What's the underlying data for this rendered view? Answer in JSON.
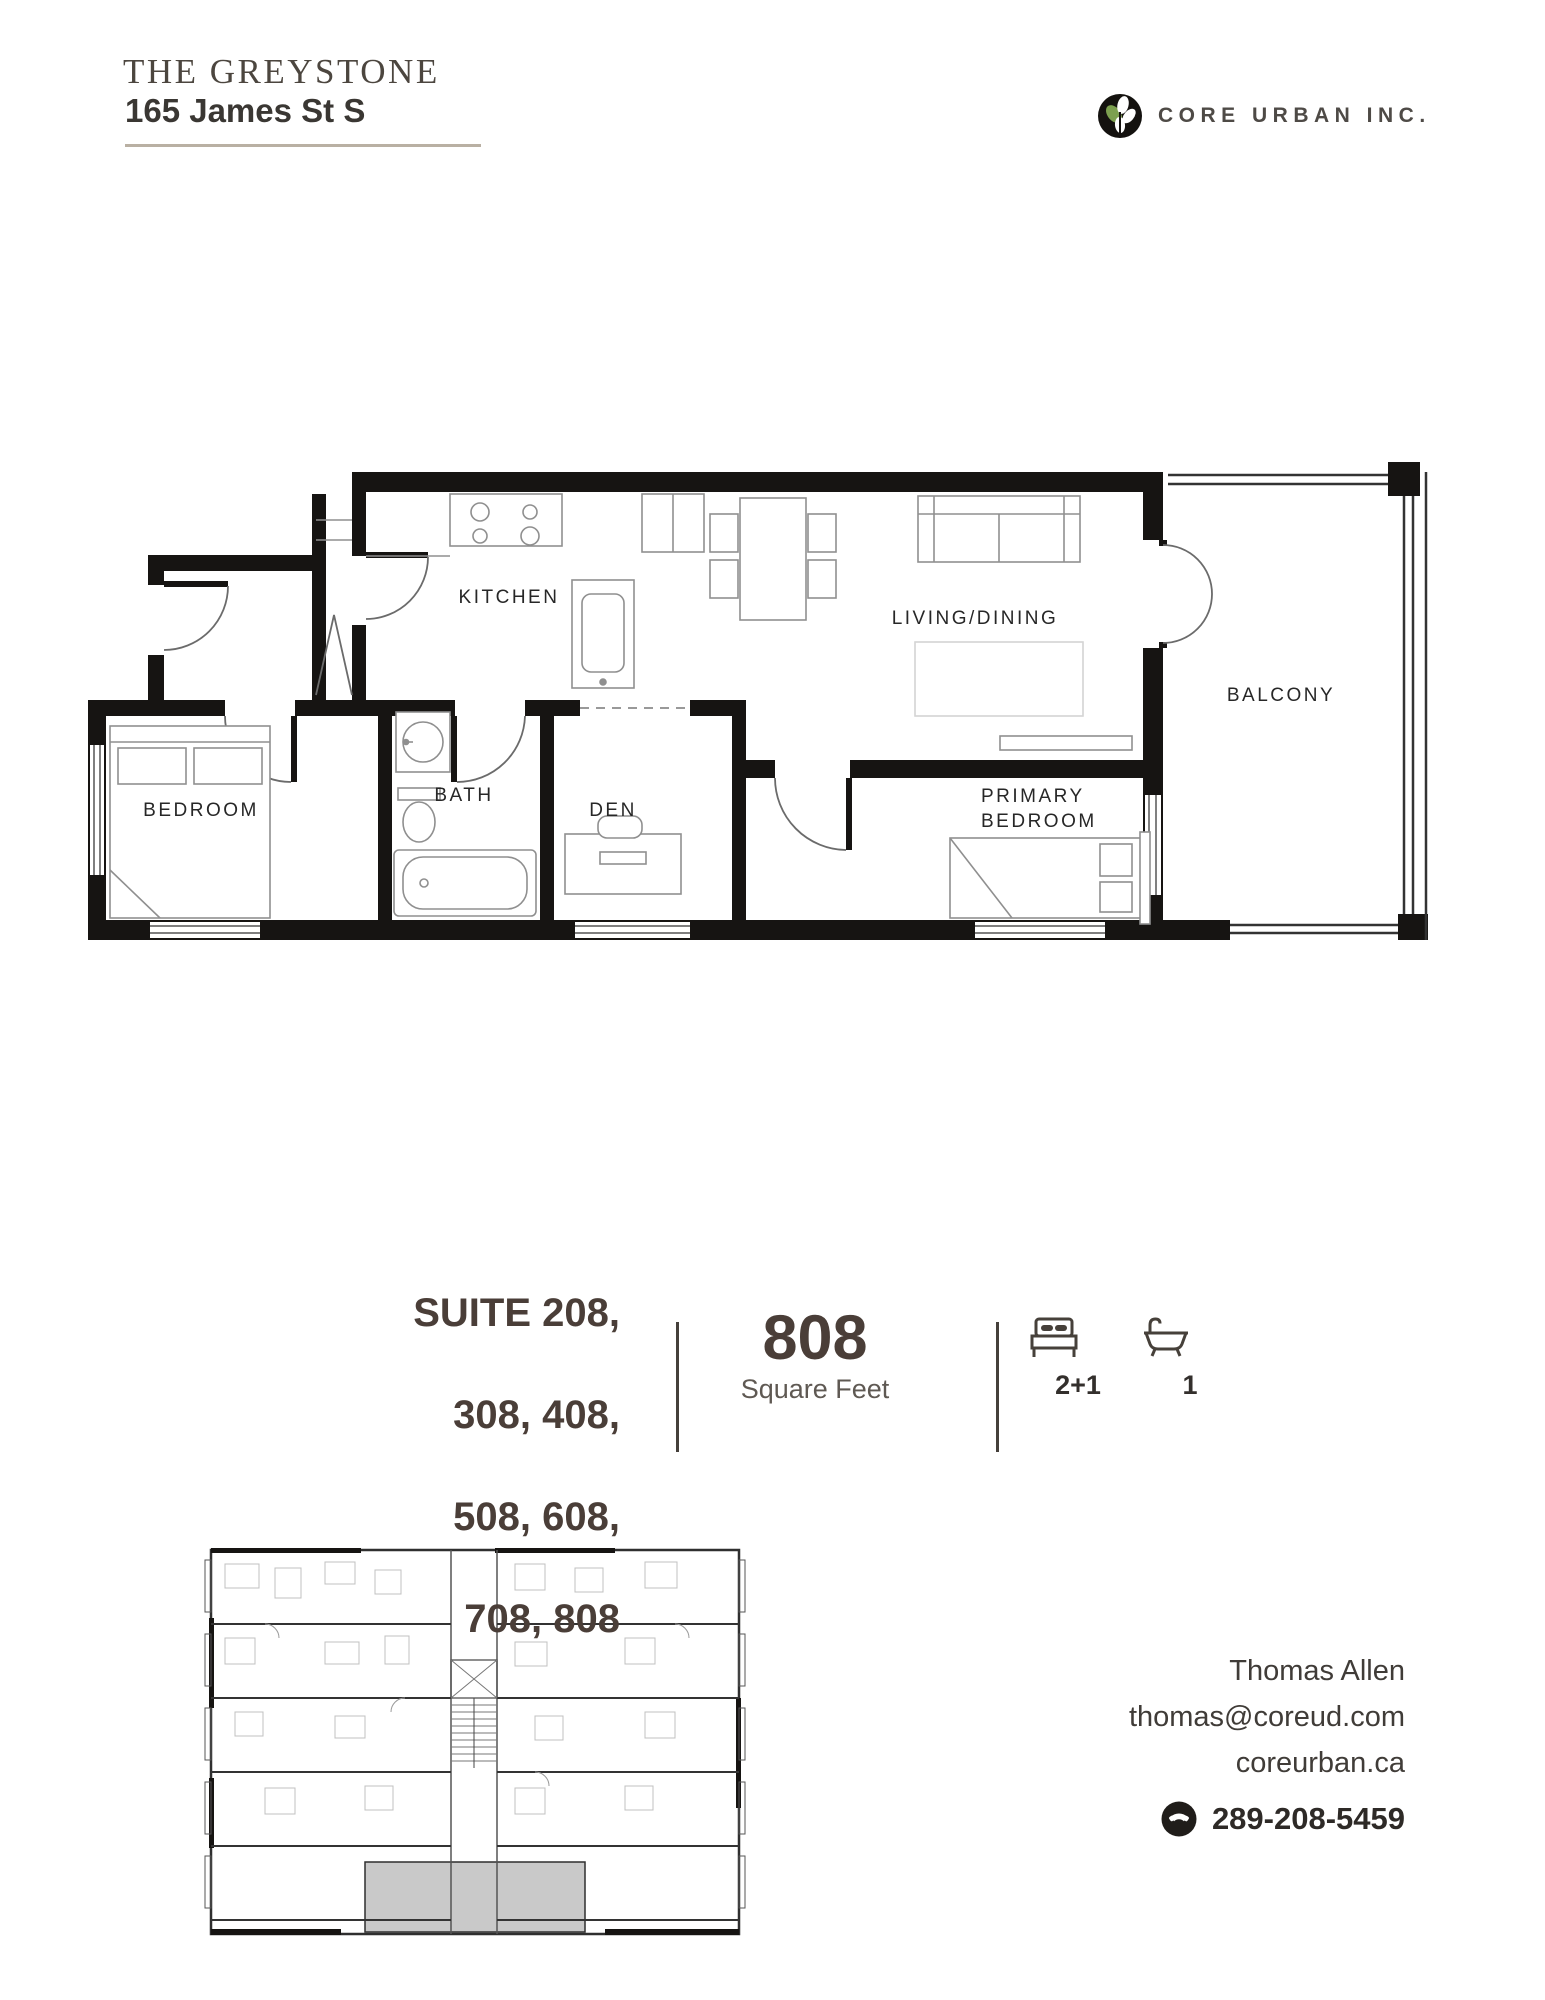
{
  "header": {
    "building": "THE GREYSTONE",
    "address": "165 James St S"
  },
  "brand": {
    "name": "CORE URBAN INC.",
    "leaf_green": "#7ca04f",
    "logo_black": "#14120f"
  },
  "plan": {
    "kitchen": "KITCHEN",
    "living": "LIVING/DINING",
    "balcony": "BALCONY",
    "bath": "BATH",
    "den": "DEN",
    "bedroom": "BEDROOM",
    "primary1": "PRIMARY",
    "primary2": "BEDROOM",
    "wall_color": "#161412",
    "highlight_gray": "#c9c9c9"
  },
  "suite": {
    "lines": [
      "SUITE 208,",
      "308, 408,",
      "508, 608,",
      "708, 808"
    ],
    "area": "808",
    "unit": "Square Feet",
    "beds": "2+1",
    "baths": "1"
  },
  "contact": {
    "name": "Thomas Allen",
    "email": "thomas@coreud.com",
    "website": "coreurban.ca",
    "phone": "289-208-5459"
  }
}
